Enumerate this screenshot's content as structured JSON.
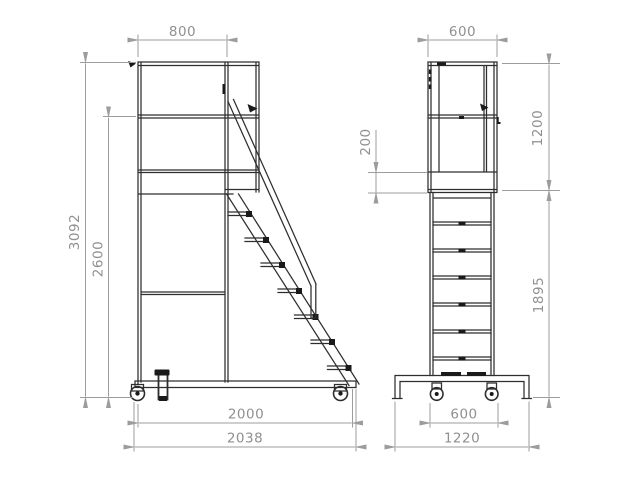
{
  "drawing": {
    "type": "technical-drawing",
    "views": {
      "side_view": {
        "dims": {
          "top_width": "800",
          "overall_height": "3092",
          "mid_rail_height": "2600",
          "wheelbase": "2000",
          "overall_length": "2038"
        }
      },
      "front_view": {
        "dims": {
          "top_width": "600",
          "toe_board_height": "200",
          "guardrail_height": "1200",
          "platform_height": "1895",
          "wheel_track": "600",
          "base_width": "1220"
        }
      }
    },
    "colors": {
      "background": "#ffffff",
      "structure_line": "#2e2e2e",
      "dimension_line": "#9c9c9c",
      "dimension_text": "#909090"
    }
  }
}
